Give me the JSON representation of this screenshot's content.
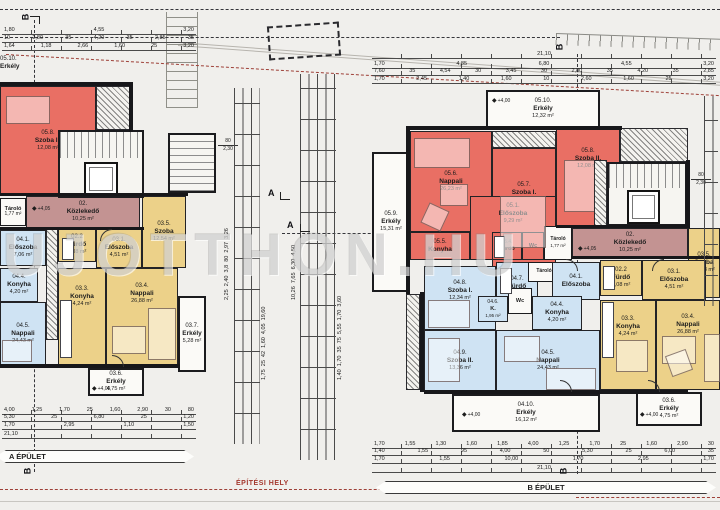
{
  "watermark": "UJOTTHON.HU",
  "labels": {
    "epitesi_hely": "ÉPÍTÉSI HELY",
    "a_epulet": "A ÉPÜLET",
    "b_epulet": "B ÉPÜLET"
  },
  "marks": {
    "sec_a": "A",
    "sec_b": "B",
    "elev_corr": "+4,05",
    "elev_plus": "+4,00",
    "stair_w": "80",
    "stair_h": "2,30",
    "diamond": "◆"
  },
  "a": {
    "erkely_0510": {
      "id": "05.10.",
      "name": "Erkély",
      "area": ""
    },
    "szoba2_058": {
      "id": "05.8.",
      "name": "Szoba II.",
      "area": "12,08 m²"
    },
    "tarolo": {
      "id": "",
      "name": "Tároló",
      "area": "1,77 m²"
    },
    "kozlekedo": {
      "id": "02.",
      "name": "Közlekedő",
      "area": "10,25 m²"
    },
    "eloszoba_041": {
      "id": "04.1.",
      "name": "Előszoba",
      "area": "7,06 m²"
    },
    "furdo_022": {
      "id": "02.2",
      "name": "Fürdő",
      "area": "4,08 m²"
    },
    "eloszoba_031": {
      "id": "03.1.",
      "name": "Előszoba",
      "area": "4,51 m²"
    },
    "szoba_035": {
      "id": "03.5.",
      "name": "Szoba",
      "area": "12,54 m²"
    },
    "konyha_044": {
      "id": "04.4.",
      "name": "Konyha",
      "area": "4,20 m²"
    },
    "nappali_045": {
      "id": "04.5.",
      "name": "Nappali",
      "area": "24,43 m²"
    },
    "konyha_033": {
      "id": "03.3.",
      "name": "Konyha",
      "area": "4,24 m²"
    },
    "nappali_034": {
      "id": "03.4.",
      "name": "Nappali",
      "area": "26,88 m²"
    },
    "erkely_037": {
      "id": "03.7.",
      "name": "Erkély",
      "area": "5,28 m²"
    },
    "erkely_036": {
      "id": "03.6.",
      "name": "Erkély",
      "area": "4,75 m²"
    }
  },
  "b": {
    "erkely_0510": {
      "id": "05.10.",
      "name": "Erkély",
      "area": "12,32 m²"
    },
    "erkely_059": {
      "id": "05.9.",
      "name": "Erkély",
      "area": "15,31 m²"
    },
    "nappali_056": {
      "id": "05.6.",
      "name": "Nappali",
      "area": "26,23 m²"
    },
    "szoba1_057": {
      "id": "05.7.",
      "name": "Szoba I.",
      "area": "14,59 m²"
    },
    "szoba2_058": {
      "id": "05.8.",
      "name": "Szoba II.",
      "area": "12,08 m²"
    },
    "konyha_055": {
      "id": "05.5.",
      "name": "Konyha",
      "area": ""
    },
    "eloszoba_051": {
      "id": "05.1.",
      "name": "Előszoba",
      "area": "9,29 m²"
    },
    "furdo_054": {
      "id": "05.4.",
      "name": "Fürdő",
      "area": ""
    },
    "wc_05": {
      "id": "",
      "name": "Wc",
      "area": ""
    },
    "tarolo_05": {
      "id": "",
      "name": "Tároló",
      "area": "1,77 m²"
    },
    "kozlekedo": {
      "id": "02.",
      "name": "Közlekedő",
      "area": "10,25 m²"
    },
    "szoba_035": {
      "id": "03.5.",
      "name": "Szoba",
      "area": "12,53 m²"
    },
    "furdo_022": {
      "id": "02.2",
      "name": "Fürdő",
      "area": "4,08 m²"
    },
    "eloszoba_031": {
      "id": "03.1.",
      "name": "Előszoba",
      "area": "4,51 m²"
    },
    "szoba1_048": {
      "id": "04.8.",
      "name": "Szoba I.",
      "area": "12,34 m²"
    },
    "furdo_047": {
      "id": "04.7.",
      "name": "Fürdő",
      "area": "5,49 m²"
    },
    "tarolo_04": {
      "id": "",
      "name": "Tároló",
      "area": ""
    },
    "eloszoba_041": {
      "id": "04.1.",
      "name": "Előszoba",
      "area": ""
    },
    "k_046": {
      "id": "04.6.",
      "name": "K.",
      "area": "1,95 m²"
    },
    "wc_04": {
      "id": "",
      "name": "Wc",
      "area": ""
    },
    "konyha_044": {
      "id": "04.4.",
      "name": "Konyha",
      "area": "4,20 m²"
    },
    "szoba2_049": {
      "id": "04.9.",
      "name": "Szoba II.",
      "area": "13,36 m²"
    },
    "nappali_045": {
      "id": "04.5.",
      "name": "Nappali",
      "area": "24,43 m²"
    },
    "erkely_0410": {
      "id": "04.10.",
      "name": "Erkély",
      "area": "16,12 m²"
    },
    "konyha_033": {
      "id": "03.3.",
      "name": "Konyha",
      "area": "4,24 m²"
    },
    "nappali_034": {
      "id": "03.4.",
      "name": "Nappali",
      "area": "26,88 m²"
    },
    "erkely_036": {
      "id": "03.6.",
      "name": "Erkély",
      "area": "4,75 m²"
    }
  },
  "dims": {
    "top_left_1": "1,80  4,55  3,20",
    "top_left_2": "10  2,80  35  4,20  35  2,85  35",
    "top_left_3": "1,64  1,18  2,66  1,60  25  3,20",
    "top_right_total": "21,10",
    "top_right_1": "1,70  4,85  6,80  4,55  3,20",
    "top_right_2": "7,60  35  4,54  30  3,45  30  2,80  35  4,20  35  2,85",
    "top_right_3": "1,70  2,45  1,40  1,60  10  2,60  1,60  25  3,20",
    "bottom_left_1": "4,00  1,25  1,70  25  1,60  2,90  30  80",
    "bottom_left_2": "5,30  25  6,80  25  1,20",
    "bottom_left_3": "1,70  2,95  1,10  1,50",
    "bottom_left_total": "21,10",
    "bottom_right_1": "1,70  1,55  1,30  1,60  1,85  4,00  1,25  1,70  25  1,60  2,90  30",
    "bottom_right_2": "1,40  1,55  95  4,00  50  5,30  25  6,00  35",
    "bottom_right_3": "1,70  1,55  10,00  1,70  2,95  1,70",
    "bottom_right_total": "21,10",
    "vert_left_1": "2,25  2,40  3,8  80  2,97  3,26",
    "vert_left_2": "1,75  25  42  1,60  4,05  19,60",
    "vert_right_1": "10,26  7,65  6,30  4,50",
    "vert_right_2": "1,40  1,70  35  75  5,55  1,70  3,60"
  }
}
